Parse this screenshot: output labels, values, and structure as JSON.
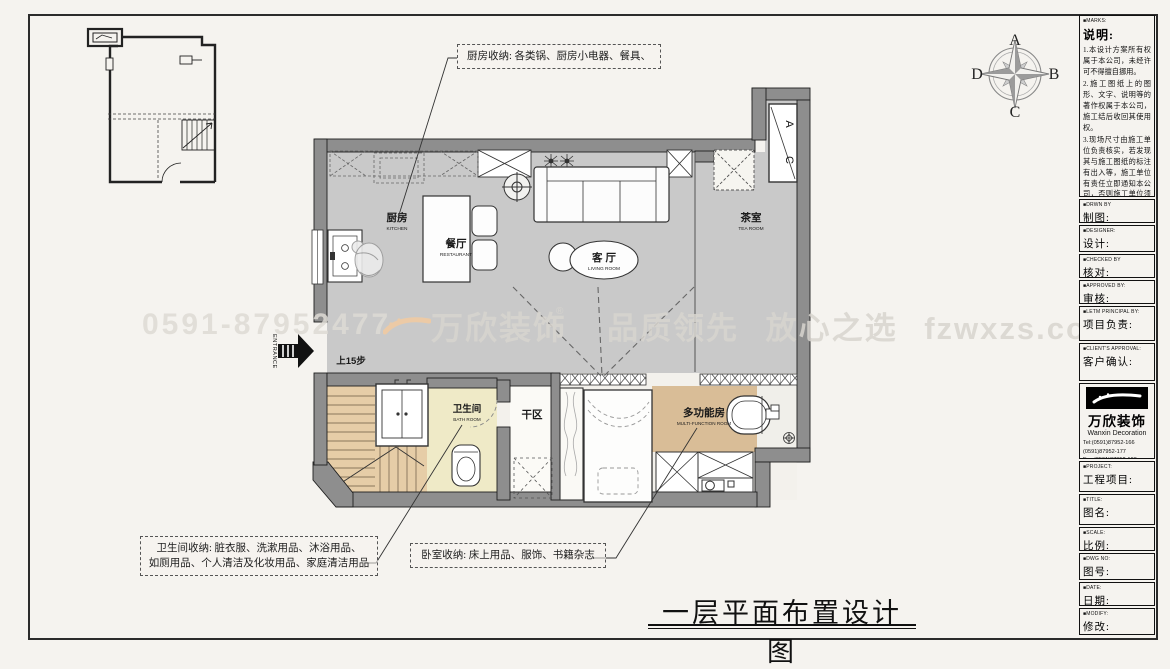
{
  "sheet": {
    "title": "一层平面布置设计图"
  },
  "plan": {
    "entrance": "ENTRANCE",
    "steps": "上15步",
    "rooms": {
      "kitchen_zh": "厨房",
      "kitchen_en": "KITCHEN",
      "dining_zh": "餐厅",
      "dining_en": "RESTAURANT",
      "living_zh": "客 厅",
      "living_en": "LIVING ROOM",
      "tea_zh": "茶室",
      "tea_en": "TEA ROOM",
      "bath_zh": "卫生间",
      "bath_en": "BATH ROOM",
      "dry_zh": "干区",
      "multi_zh": "多功能房",
      "multi_en": "MULTI-FUNCTION ROOM",
      "ac_a": "A",
      "ac_c": "C"
    }
  },
  "compass": {
    "n": "A",
    "e": "B",
    "s": "C",
    "w": "D"
  },
  "callouts": {
    "kitchen": "厨房收纳: 各类锅、厨房小电器、餐具、",
    "bath_line1": "卫生间收纳: 脏衣服、洗漱用品、沐浴用品、",
    "bath_line2": "如厕用品、个人清洁及化妆用品、家庭清洁用品",
    "bedroom": "卧室收纳: 床上用品、服饰、书籍杂志"
  },
  "watermark": {
    "phone": "0591-87952477",
    "brand": "万欣装饰",
    "reg": "®",
    "slogan": "品质领先 放心之选 fzwxzs.com"
  },
  "titleblock": {
    "marks_en": "■MARKS:",
    "marks_zh": "说明:",
    "notes": [
      "1.本设计方案所有权属于本公司，未经许可不得擅自挪用。",
      "2.施工图纸上的图形、文字、说明等的著作权属于本公司，施工结后收回其使用权。",
      "3.现场尺寸由施工单位负责核实，若发现其与施工图纸的标注有出入等，施工单位有责任立即通知本公司，否则施工单位须承担所有责任。",
      "4.本设计方案是依客户要求设计，经客户签字确认为同意认可，不得随意更改。"
    ],
    "rows": [
      {
        "en": "■DRWN BY",
        "zh": "制图:"
      },
      {
        "en": "■DESIGNER:",
        "zh": "设计:"
      },
      {
        "en": "■CHECKED BY",
        "zh": "核对:"
      },
      {
        "en": "■APPROVED BY:",
        "zh": "审核:"
      },
      {
        "en": "■LETM PRINCIPAL BY:",
        "zh": "项目负责:"
      },
      {
        "en": "■CLIENT'S APPROVAL:",
        "zh": "客户确认:"
      }
    ],
    "company": {
      "name": "万欣装饰",
      "sub": "Wanxin Decoration",
      "tel1": "Tel:(0591)87952-166",
      "tel2": "(0591)87952-177",
      "fax": "Fax:(0591)87952-199",
      "web": "Web:WWW.fzwxzs.com"
    },
    "rows2": [
      {
        "en": "■PROJECT:",
        "zh": "工程项目:"
      },
      {
        "en": "■TITLE:",
        "zh": "图名:"
      },
      {
        "en": "■SCALE:",
        "zh": "比例:"
      },
      {
        "en": "■DWG NO:",
        "zh": "图号:"
      },
      {
        "en": "■DATE:",
        "zh": "日期:"
      },
      {
        "en": "■MODIFY:",
        "zh": "修改:"
      }
    ]
  }
}
